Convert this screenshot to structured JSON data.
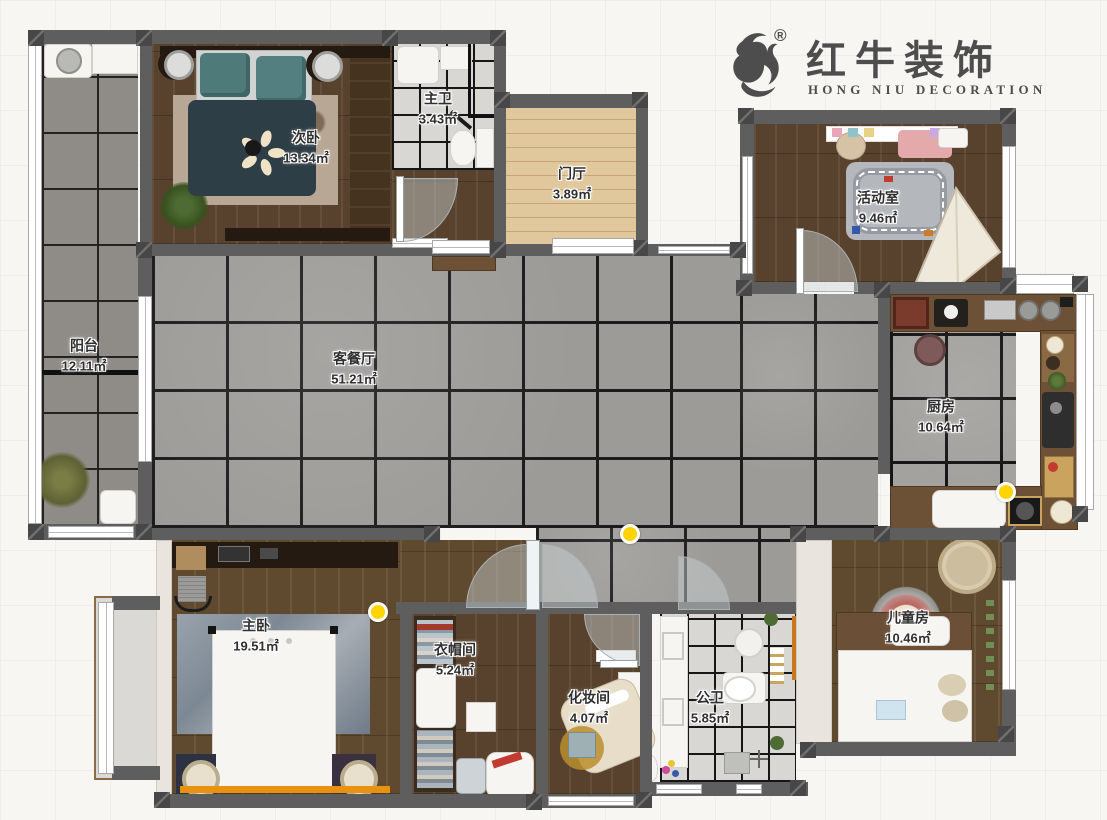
{
  "logo": {
    "brand": "红牛装饰",
    "subtitle": "HONG NIU DECORATION",
    "registered": "®",
    "mark": "bull-swoosh",
    "color": "#4d4d4d"
  },
  "rooms": {
    "yangtai": {
      "name": "阳台",
      "area": "12.11㎡"
    },
    "ciwo": {
      "name": "次卧",
      "area": "13.34㎡"
    },
    "zhuwei": {
      "name": "主卫",
      "area": "3.43㎡"
    },
    "menting": {
      "name": "门厅",
      "area": "3.89㎡"
    },
    "huodongshi": {
      "name": "活动室",
      "area": "9.46㎡"
    },
    "kecanting": {
      "name": "客餐厅",
      "area": "51.21㎡"
    },
    "chufang": {
      "name": "厨房",
      "area": "10.64㎡"
    },
    "zhuwo": {
      "name": "主卧",
      "area": "19.51㎡"
    },
    "yimaojian": {
      "name": "衣帽间",
      "area": "5.24㎡"
    },
    "huazhuangjian": {
      "name": "化妆间",
      "area": "4.07㎡"
    },
    "gongwei": {
      "name": "公卫",
      "area": "5.85㎡"
    },
    "ertongfang": {
      "name": "儿童房",
      "area": "10.46㎡"
    }
  },
  "colors": {
    "wall": "#5e5e5e",
    "living_tile": "#9d9b98",
    "balcony_tile": "#8f8b86",
    "bath_tile": "#d8d7d4",
    "dark_wood": "#58422d",
    "entry_wood": "#e0c79c",
    "light_marker": "#ffd400",
    "bench_accent": "#e8920f"
  }
}
